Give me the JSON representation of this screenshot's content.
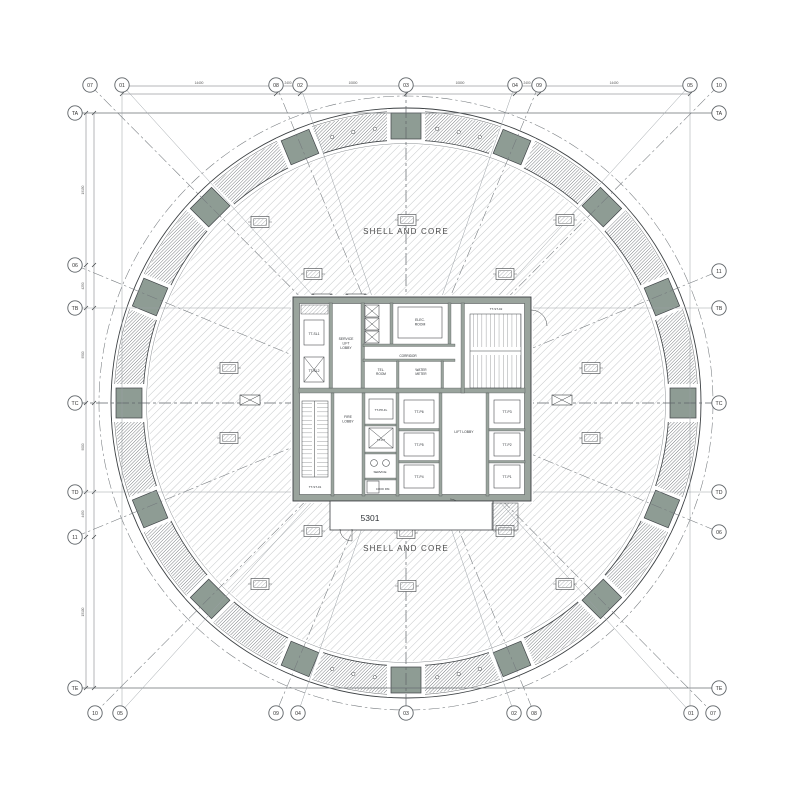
{
  "drawing": {
    "shell_core_top": "SHELL AND CORE",
    "shell_core_bottom": "SHELL AND CORE",
    "unit_number": "5301"
  },
  "colors": {
    "mega_column_sage": "#8e9c94",
    "core_wall_gray": "#9aa49d",
    "line_dark": "#3c4043"
  },
  "grid_bubbles": {
    "top": [
      {
        "label": "07",
        "x": 90
      },
      {
        "label": "01",
        "x": 122
      },
      {
        "label": "08",
        "x": 276
      },
      {
        "label": "02",
        "x": 300
      },
      {
        "label": "03",
        "x": 406
      },
      {
        "label": "04",
        "x": 515
      },
      {
        "label": "09",
        "x": 539
      },
      {
        "label": "05",
        "x": 690
      },
      {
        "label": "10",
        "x": 719
      }
    ],
    "bottom": [
      {
        "label": "10",
        "x": 95
      },
      {
        "label": "05",
        "x": 120
      },
      {
        "label": "09",
        "x": 276
      },
      {
        "label": "04",
        "x": 298
      },
      {
        "label": "03",
        "x": 406
      },
      {
        "label": "02",
        "x": 514
      },
      {
        "label": "08",
        "x": 534
      },
      {
        "label": "01",
        "x": 691
      },
      {
        "label": "07",
        "x": 713
      }
    ],
    "left": [
      {
        "label": "TA",
        "y": 113
      },
      {
        "label": "06",
        "y": 265
      },
      {
        "label": "TB",
        "y": 308
      },
      {
        "label": "TC",
        "y": 403
      },
      {
        "label": "TD",
        "y": 492
      },
      {
        "label": "11",
        "y": 537
      },
      {
        "label": "TE",
        "y": 688
      }
    ],
    "right": [
      {
        "label": "TA",
        "y": 113
      },
      {
        "label": "11",
        "y": 271
      },
      {
        "label": "TB",
        "y": 308
      },
      {
        "label": "TC",
        "y": 403
      },
      {
        "label": "TD",
        "y": 492
      },
      {
        "label": "06",
        "y": 532
      },
      {
        "label": "TE",
        "y": 688
      }
    ]
  },
  "room_labels": [
    {
      "id": "tt-sl1",
      "lines": [
        "TT-SL1"
      ],
      "x": 314,
      "y": 335,
      "s": 3.4
    },
    {
      "id": "service-lift-lobby",
      "lines": [
        "SERVICE",
        "LIFT",
        "LOBBY"
      ],
      "x": 346,
      "y": 340,
      "s": 3.4
    },
    {
      "id": "tt-sl2",
      "lines": [
        "TT-SL2"
      ],
      "x": 314,
      "y": 372,
      "s": 3.4
    },
    {
      "id": "elec-room",
      "lines": [
        "ELEC.",
        "ROOM"
      ],
      "x": 420,
      "y": 321,
      "s": 3.4
    },
    {
      "id": "corridor",
      "lines": [
        "CORRIDOR"
      ],
      "x": 408,
      "y": 357,
      "s": 3.2
    },
    {
      "id": "tel-room",
      "lines": [
        "TEL.",
        "ROOM"
      ],
      "x": 381,
      "y": 371,
      "s": 3.2
    },
    {
      "id": "water-meter",
      "lines": [
        "WATER",
        "METER"
      ],
      "x": 421,
      "y": 371,
      "s": 3.2
    },
    {
      "id": "tt-st-02",
      "lines": [
        "TT-ST-02"
      ],
      "x": 496,
      "y": 310,
      "s": 3.0
    },
    {
      "id": "tt-st-01",
      "lines": [
        "TT-ST-01"
      ],
      "x": 315,
      "y": 488,
      "s": 3.0
    },
    {
      "id": "fire-lobby",
      "lines": [
        "FIRE",
        "LOBBY"
      ],
      "x": 348,
      "y": 418,
      "s": 3.4
    },
    {
      "id": "tt-p8-fl",
      "lines": [
        "TT-P8-FL"
      ],
      "x": 381,
      "y": 411,
      "s": 3.0
    },
    {
      "id": "tt-p7",
      "lines": [
        "TT-P7"
      ],
      "x": 381,
      "y": 441,
      "s": 3.0
    },
    {
      "id": "service",
      "lines": [
        "SERVICE"
      ],
      "x": 380,
      "y": 473,
      "s": 3.0
    },
    {
      "id": "cook-rm",
      "lines": [
        "COOK  RM."
      ],
      "x": 383,
      "y": 490,
      "s": 2.8
    },
    {
      "id": "tt-p6",
      "lines": [
        "TT-P6"
      ],
      "x": 419,
      "y": 413,
      "s": 3.4
    },
    {
      "id": "tt-p5",
      "lines": [
        "TT-P5"
      ],
      "x": 419,
      "y": 446,
      "s": 3.4
    },
    {
      "id": "tt-p4",
      "lines": [
        "TT-P4"
      ],
      "x": 419,
      "y": 478,
      "s": 3.4
    },
    {
      "id": "lift-lobby",
      "lines": [
        "LIFT LOBBY"
      ],
      "x": 464,
      "y": 433,
      "s": 3.4
    },
    {
      "id": "tt-p3",
      "lines": [
        "TT-P3"
      ],
      "x": 507,
      "y": 413,
      "s": 3.4
    },
    {
      "id": "tt-p2",
      "lines": [
        "TT-P2"
      ],
      "x": 507,
      "y": 446,
      "s": 3.4
    },
    {
      "id": "tt-p1",
      "lines": [
        "TT-P1"
      ],
      "x": 507,
      "y": 478,
      "s": 3.4
    }
  ],
  "dimensions": {
    "top": [
      {
        "x": 199,
        "text": "14400"
      },
      {
        "x": 288,
        "text": "2400"
      },
      {
        "x": 353,
        "text": "10800"
      },
      {
        "x": 460,
        "text": "10800"
      },
      {
        "x": 527,
        "text": "2400"
      },
      {
        "x": 614,
        "text": "14400"
      }
    ],
    "left": [
      {
        "y": 190,
        "text": "19150"
      },
      {
        "y": 286,
        "text": "4250"
      },
      {
        "y": 355,
        "text": "9500"
      },
      {
        "y": 447,
        "text": "9000"
      },
      {
        "y": 514,
        "text": "4450"
      },
      {
        "y": 612,
        "text": "15100"
      }
    ]
  }
}
